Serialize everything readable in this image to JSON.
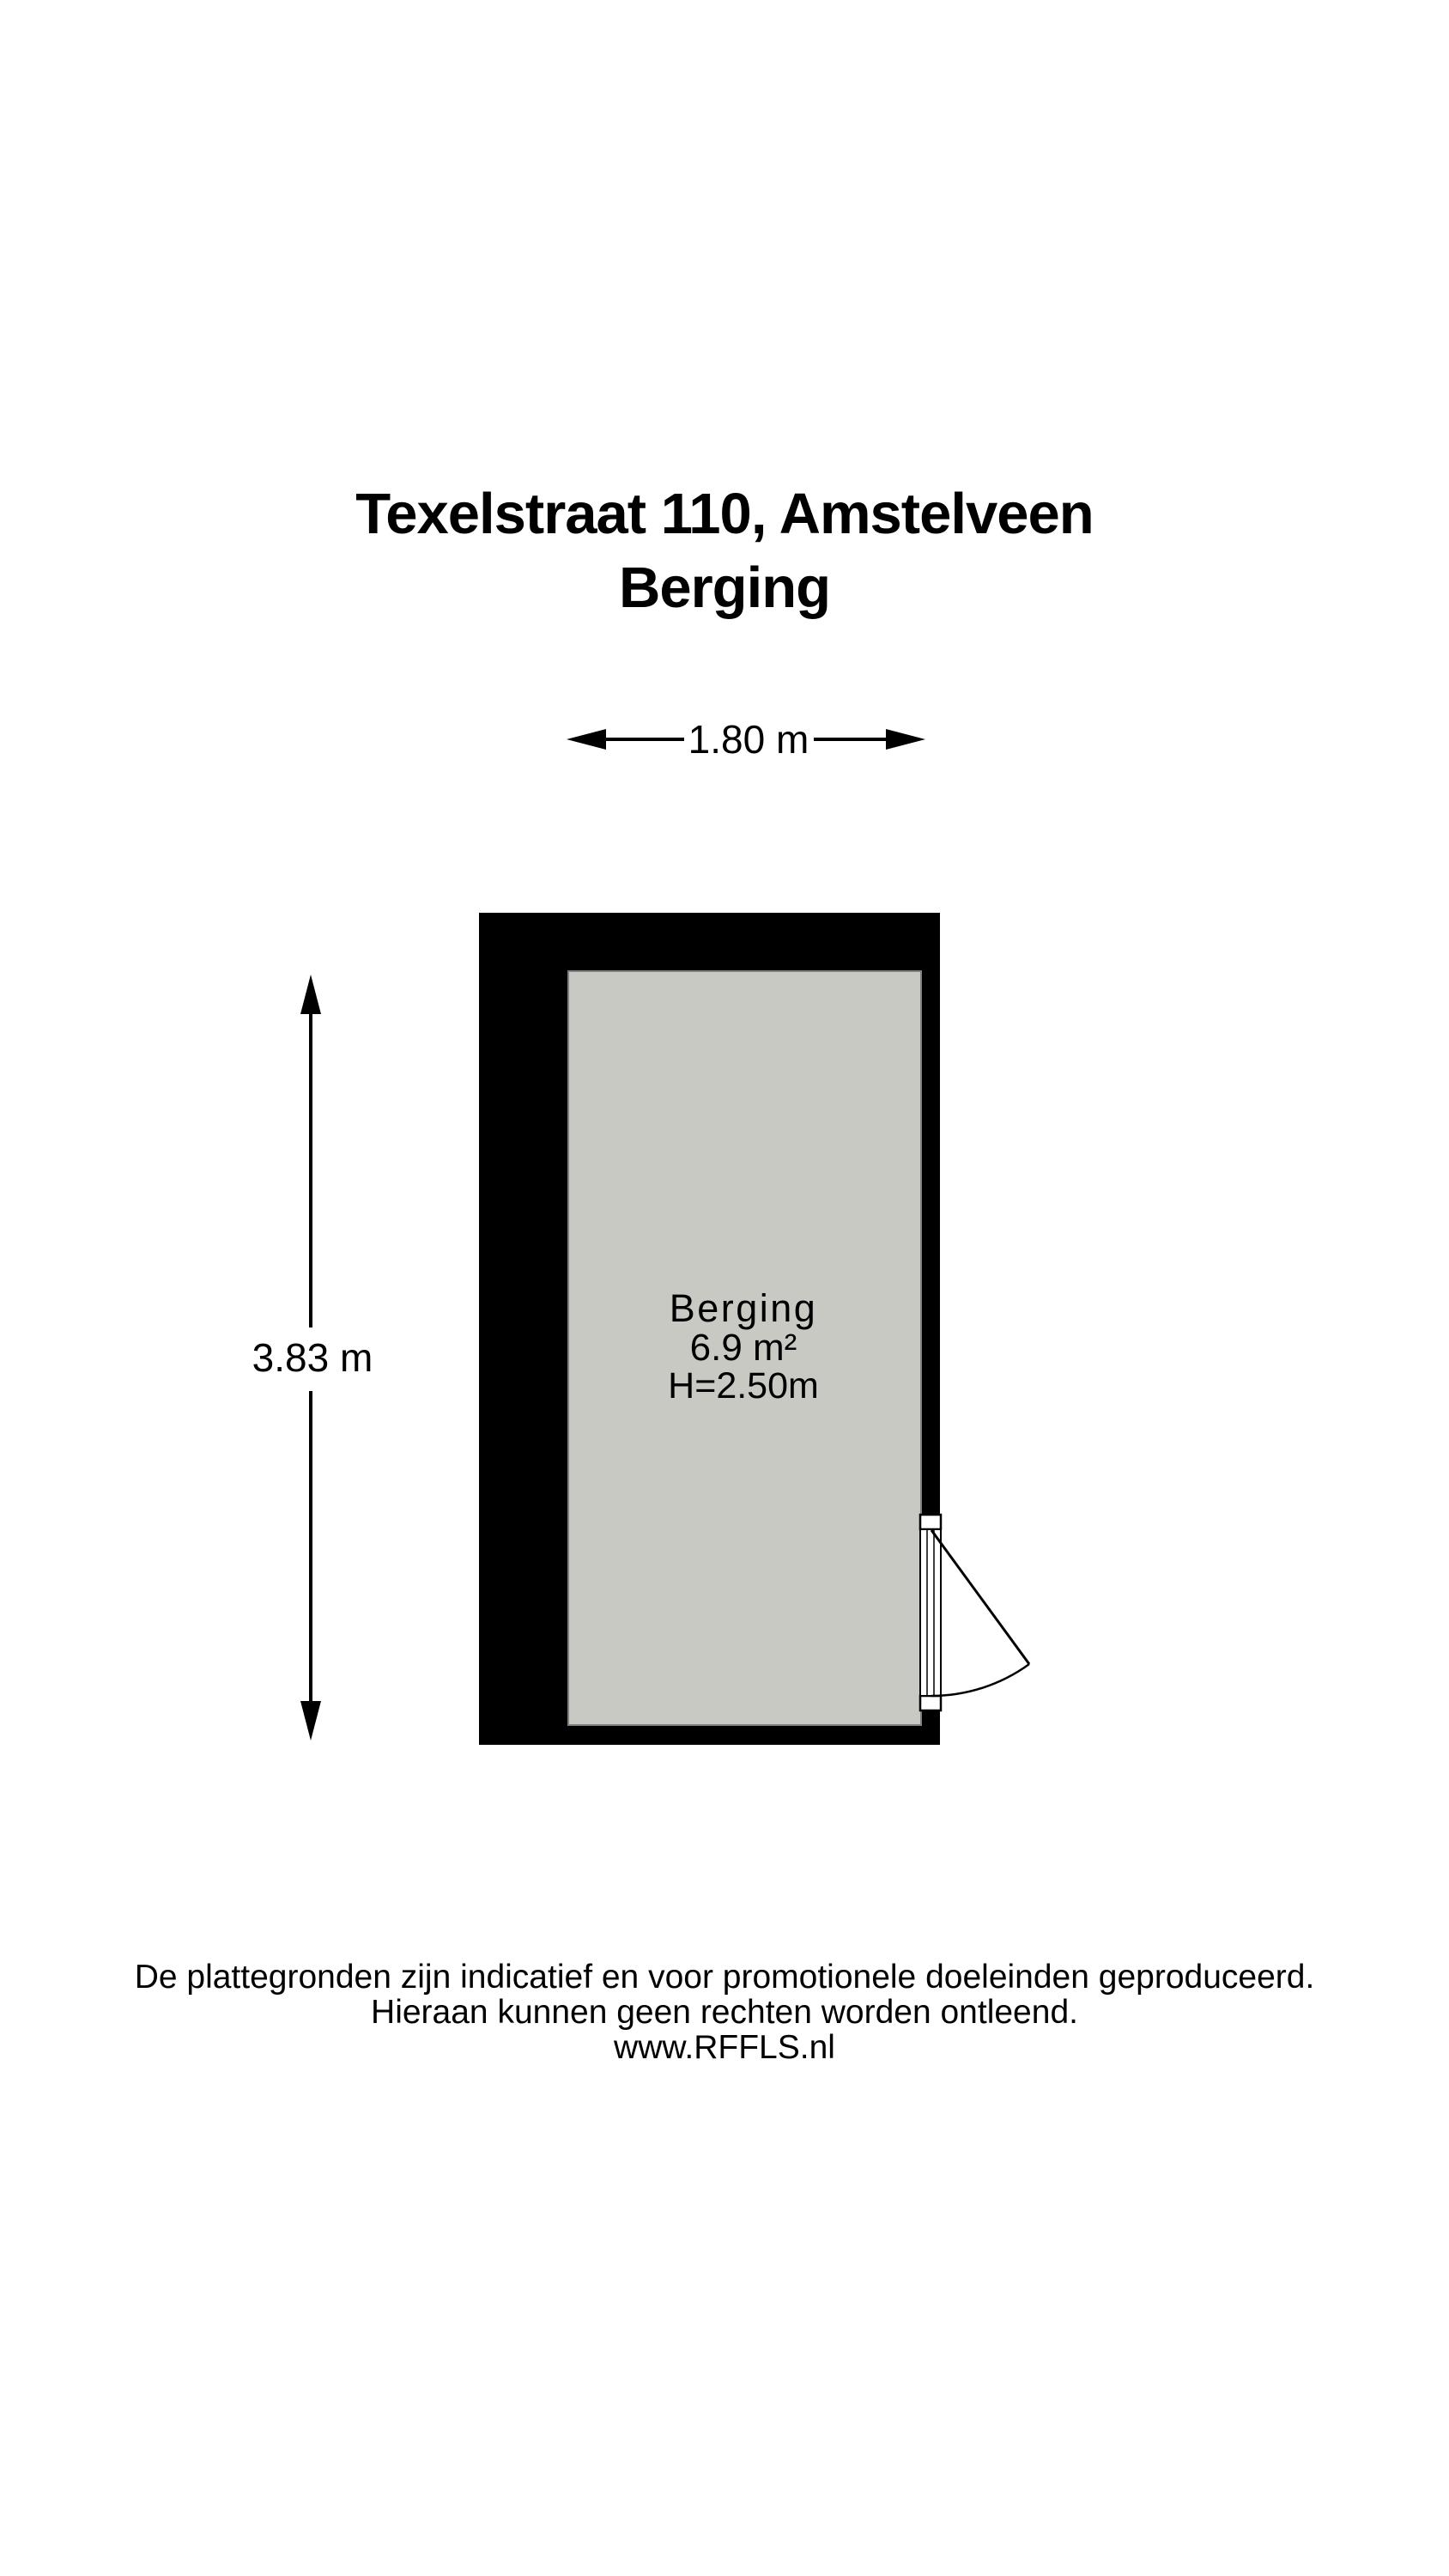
{
  "title": {
    "address": "Texelstraat 110, Amstelveen",
    "subtitle": "Berging"
  },
  "dimensions": {
    "width": "1.80 m",
    "height": "3.83 m"
  },
  "room": {
    "name": "Berging",
    "area": "6.9 m²",
    "ceiling_height": "H=2.50m"
  },
  "footer": {
    "line1": "De plattegronden zijn indicatief en voor promotionele doeleinden geproduceerd.",
    "line2": "Hieraan kunnen geen rechten worden ontleend.",
    "line3": "www.RFFLS.nl"
  },
  "colors": {
    "wall": "#000000",
    "floor": "#C9C9C3",
    "floor_border": "#7F7F7F",
    "line": "#000000",
    "background": "#FFFFFF"
  }
}
